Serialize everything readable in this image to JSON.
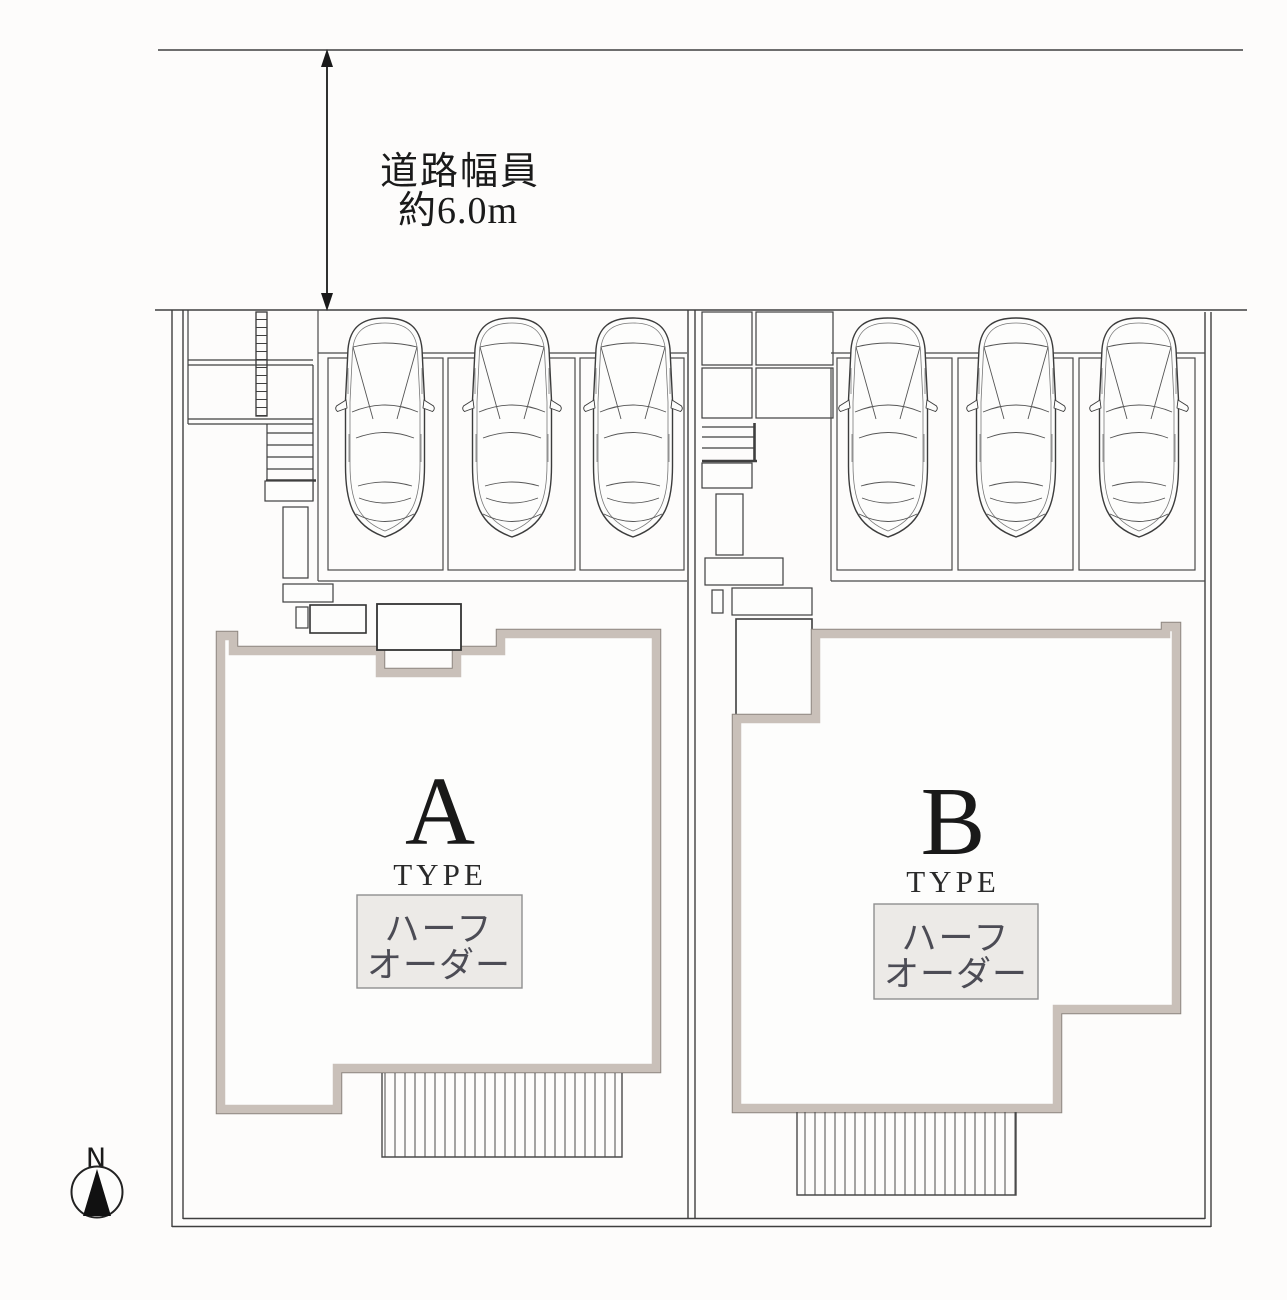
{
  "page": {
    "background": "#fdfcfb",
    "kind": "residential site plan"
  },
  "road": {
    "dimension_line1": "道路幅員",
    "dimension_line2": "約6.0m"
  },
  "compass": {
    "north_label": "N"
  },
  "lots": [
    {
      "id": "A",
      "letter": "A",
      "type_label": "TYPE",
      "order_line1": "ハーフ",
      "order_line2": "オーダー",
      "parking_spaces": 3
    },
    {
      "id": "B",
      "letter": "B",
      "type_label": "TYPE",
      "order_line1": "ハーフ",
      "order_line2": "オーダー",
      "parking_spaces": 3
    }
  ],
  "colors": {
    "wall_outline": "#c9c0b9",
    "wall_edge": "#8d867f",
    "line": "#3f3f3f",
    "thin_line": "#6e6e6e",
    "order_box_fill": "#eceae7",
    "order_box_border": "#8f8f8f",
    "order_box_text": "#4c4c55",
    "label_text": "#1a1a1a"
  }
}
